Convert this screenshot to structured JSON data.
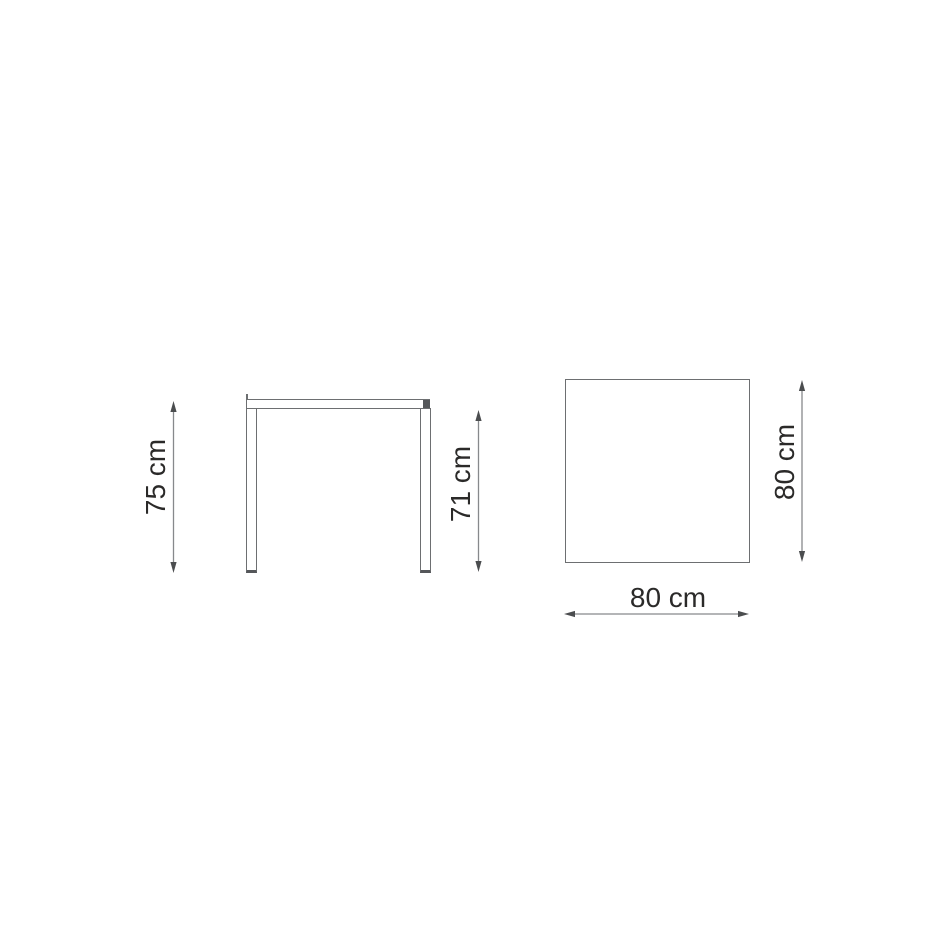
{
  "diagram": {
    "type": "furniture-dimension-drawing",
    "subject": "square table",
    "views": {
      "front": {
        "name": "front elevation",
        "dimensions": {
          "overall_height": "75 cm",
          "underside_height": "71 cm"
        }
      },
      "top": {
        "name": "tabletop plan",
        "dimensions": {
          "depth": "80 cm",
          "width": "80 cm"
        }
      }
    }
  },
  "colors": {
    "background": "#ffffff",
    "object-line": "#6d6f71",
    "object-line-dark": "#55575a",
    "dimension-line": "#87898c",
    "arrow": "#4b4d4f",
    "text": "#2b2a29"
  }
}
